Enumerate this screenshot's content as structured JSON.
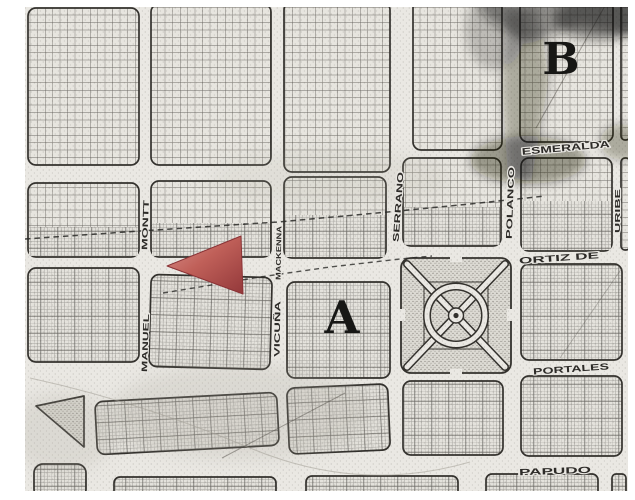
{
  "map": {
    "district_labels": {
      "a": "A",
      "b": "B"
    },
    "streets": {
      "esmeralda": "ESMERALDA",
      "serrano": "SERRANO",
      "polanco": "POLANCO",
      "ortiz_de": "ORTIZ DE",
      "uribe": "URIBE",
      "portales": "PORTALES",
      "papudo": "PAPUDO",
      "montt": "MONTT",
      "manuel": "MANUEL",
      "mackenna": "MACKENNA",
      "vicuna": "VICUÑA"
    },
    "marker": {
      "icon": "red-left-arrow-marker",
      "color": "#b55151"
    },
    "features": {
      "plaza": "round-plaza-with-diagonal-paths",
      "shaded_area": "dark-shading-top-right",
      "boundary": "dashed-line"
    },
    "colors": {
      "paper": "#eae8e3",
      "ink": "#33312d",
      "label_ink": "#2d2b28",
      "shading": "#141310",
      "marker_red": "#b55151"
    }
  }
}
